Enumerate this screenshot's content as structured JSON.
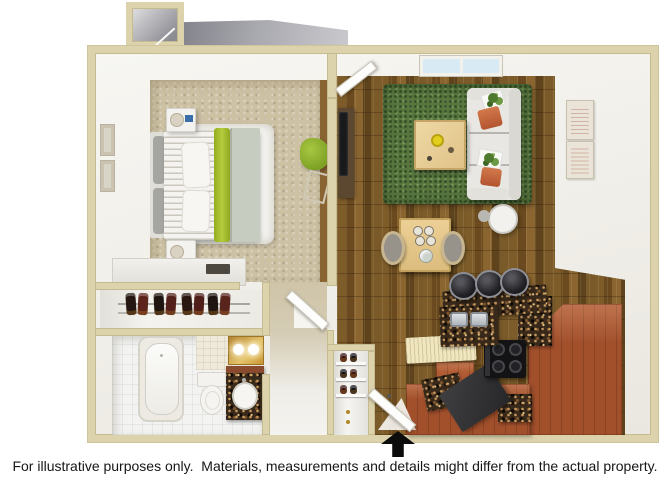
{
  "meta": {
    "width": 670,
    "height": 480,
    "background": "#ffffff",
    "description": "3D top-down rendered floor plan of a one-bedroom / one-bath apartment"
  },
  "footer": {
    "disclaimer": "For illustrative purposes only.  Materials, measurements and details might differ from the actual property."
  },
  "floorplan": {
    "entry_marker": "black up-arrow at bottom center marking the apartment entrance",
    "rooms": [
      {
        "name": "bedroom",
        "floor": "tan carpet"
      },
      {
        "name": "living-room",
        "floor": "hardwood planks"
      },
      {
        "name": "kitchen",
        "floor": "hardwood planks"
      },
      {
        "name": "bathroom",
        "floor": "white tile"
      },
      {
        "name": "bedroom-closet",
        "contents": "shoe rack"
      },
      {
        "name": "entry-closet",
        "contents": "shoe shelves"
      },
      {
        "name": "hallway",
        "floor": "tan"
      }
    ],
    "furniture": [
      "bed with lime and sage bedding",
      "two nightstands with lamps",
      "white shag rug",
      "dresser",
      "lime accent chair",
      "tv-console",
      "white sofa with orange pillows and plants",
      "light wood coffee table",
      "green shag area rug",
      "dining table with two chairs",
      "round side table",
      "three black bar stools",
      "granite breakfast bar",
      "double stainless sink",
      "black four-burner stove",
      "terracotta cabinets",
      "bathtub",
      "toilet",
      "granite vanity with sink",
      "gold lighted mirror",
      "window"
    ],
    "colors": {
      "wall_beige": "#dcd3ad",
      "carpet_tan": "#cdc1a4",
      "wood_floor": "#76561f",
      "rug_green": "#58773f",
      "sofa_white": "#e8e7e3",
      "pillow_orange": "#c2633a",
      "accent_lime": "#a4c232",
      "granite_brown": "#38291a",
      "cabinet_terracotta": "#a2502c",
      "stove_black": "#131315",
      "mirror_gold": "#c9952f",
      "window_glass": "#d8eaf3",
      "roof_gray": "#9c9ca4",
      "arrow_black": "#0c0c0c",
      "text_black": "#161616"
    }
  }
}
